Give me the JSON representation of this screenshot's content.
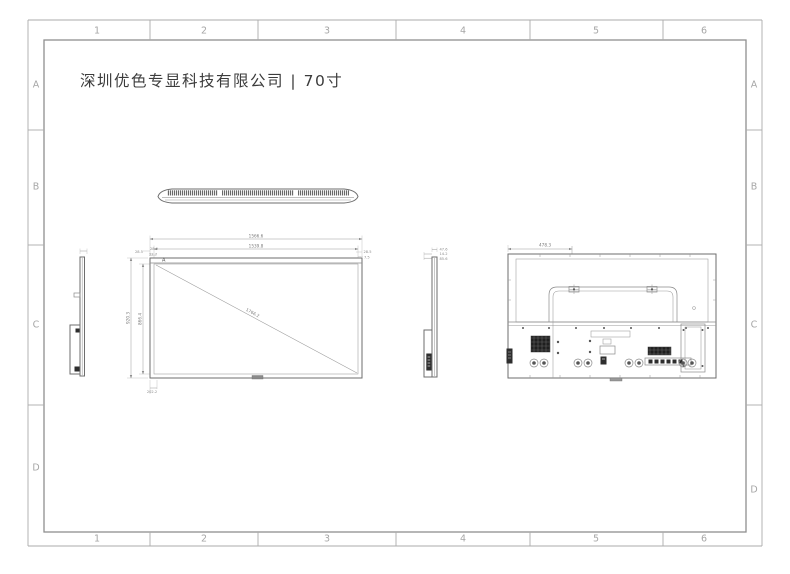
{
  "sheet": {
    "title": "深圳优色专显科技有限公司 | 70寸",
    "grid": {
      "columns": [
        "1",
        "2",
        "3",
        "4",
        "5",
        "6"
      ],
      "rows": [
        "A",
        "B",
        "C",
        "D"
      ]
    }
  },
  "views": {
    "front": {
      "corner_marker": "A",
      "dims": {
        "width_outer": "1566.6",
        "width_active": "1539.8",
        "height_outer": "920.3",
        "height_active": "866.4",
        "diagonal": "1766.2",
        "bottom_offset": "202.2",
        "top_left_a": "28.5",
        "top_left_b": "28.9",
        "top_left_c": "22.7",
        "top_right_a": "28.5",
        "top_right_b": "7.5"
      }
    },
    "side_right": {
      "dims": {
        "a": "47.6",
        "b": "14.2",
        "c": "85.6"
      }
    },
    "back": {
      "dims": {
        "offset_top": "478.3",
        "offset_vertical": "252.6",
        "mount_span": "600",
        "offset_lower": "358"
      }
    }
  },
  "colors": {
    "outline": "#6e6e6e",
    "dim_text": "#7a7a7a",
    "grid_label": "#a6a6a6",
    "title_text": "#3c3c3c",
    "frame": "#8f8f8f"
  }
}
